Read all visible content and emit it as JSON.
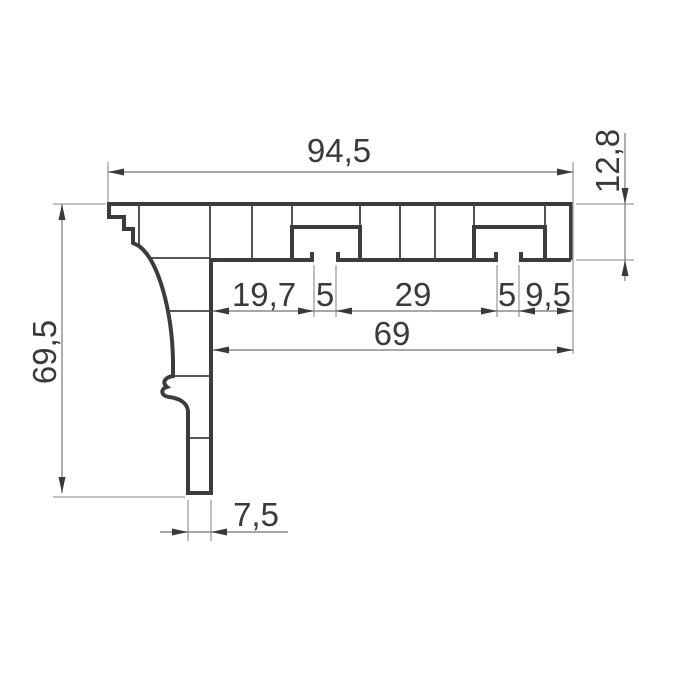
{
  "drawing": {
    "kind": "profile-cross-section-technical-drawing",
    "decimal_style": "comma",
    "colors": {
      "background": "#ffffff",
      "profile_outline": "#3a3d40",
      "dimension_lines": "#8a8a8a",
      "dimension_text": "#3a3a3a"
    },
    "dimensions": {
      "overall_width": "94,5",
      "top_flange_height": "12,8",
      "overall_height": "69,5",
      "web_to_slot1_channel": "19,7",
      "slot1_channel_width": "5",
      "slot1_to_slot2_spacing": "29",
      "slot2_channel_width": "5",
      "slot2_channel_to_edge": "9,5",
      "web_to_right_edge": "69",
      "leg_thickness": "7,5"
    },
    "features": {
      "screw_slot_count": 2,
      "left_end": "stepped rebate",
      "left_side": "concave cove curve with bead detail",
      "bottom": "narrow closed leg"
    }
  }
}
